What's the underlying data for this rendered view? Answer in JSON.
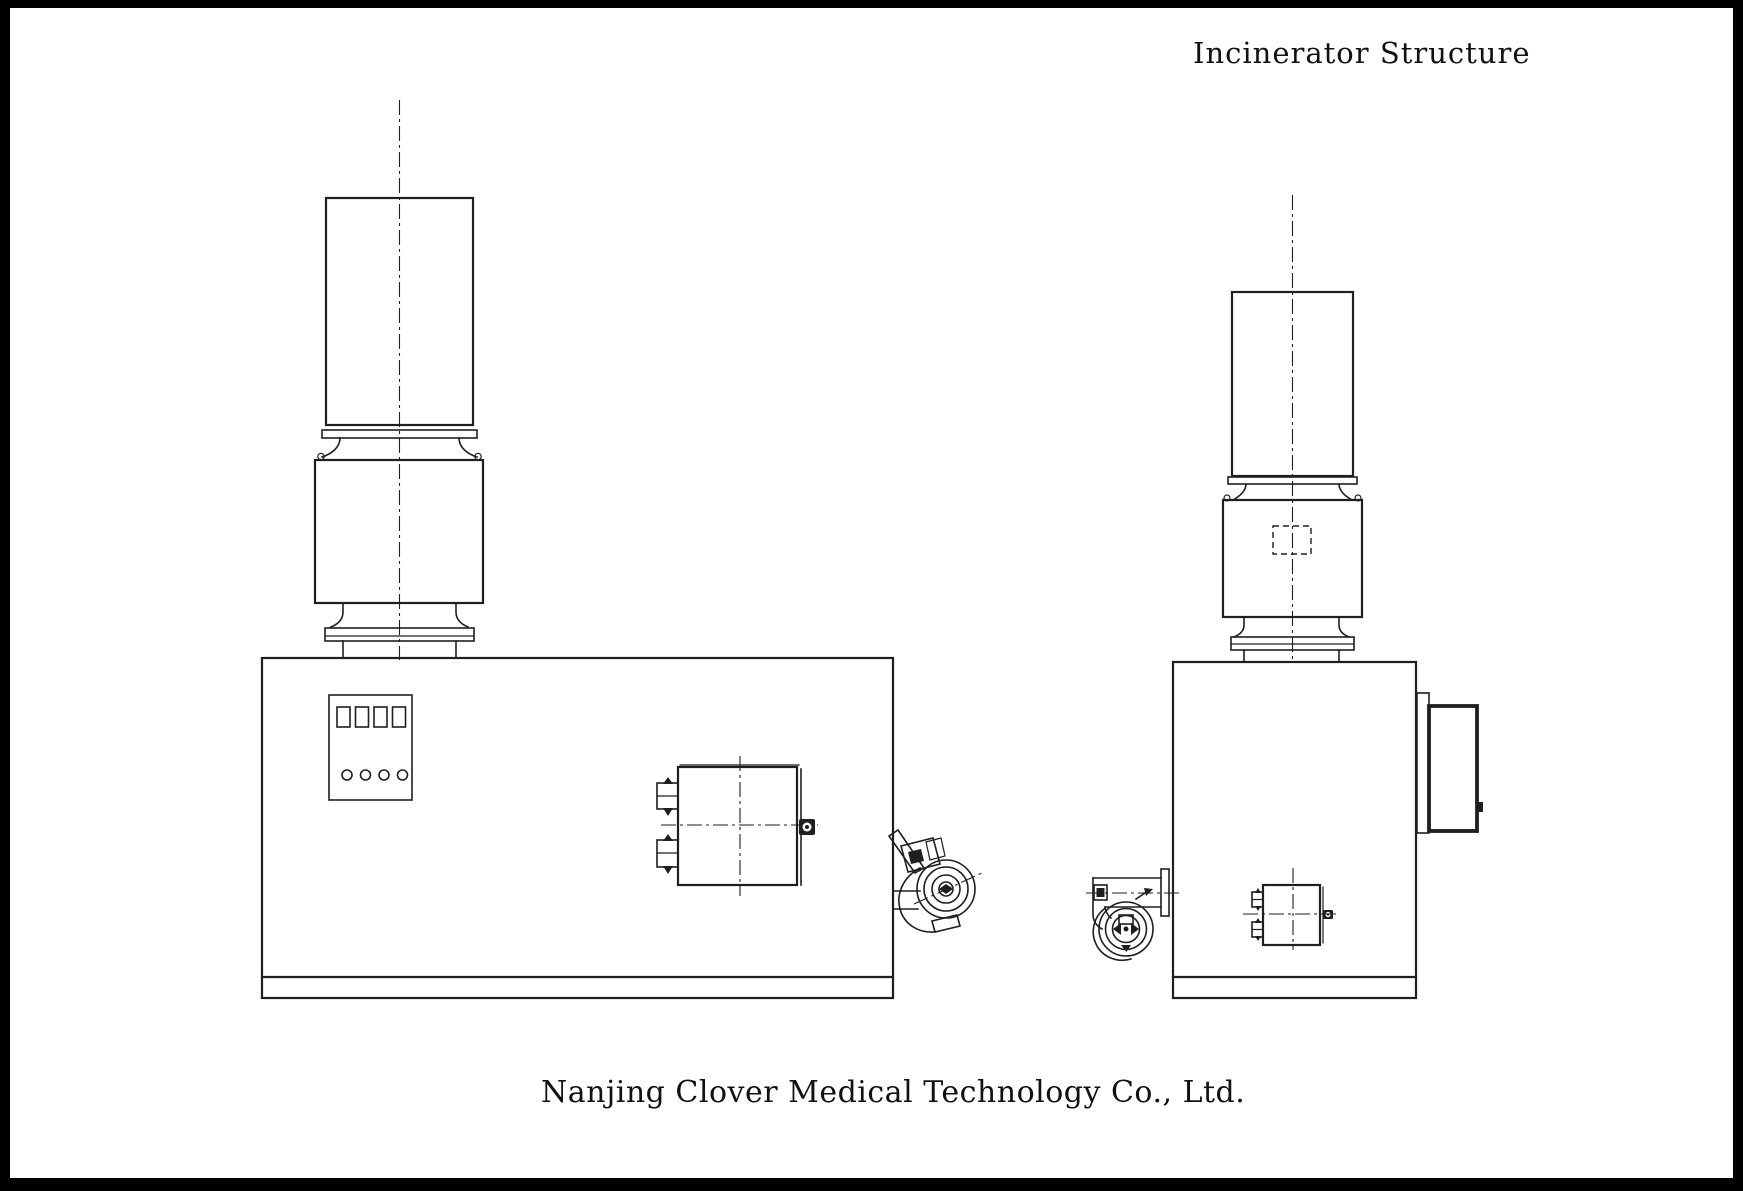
{
  "header": {
    "title": "Incinerator Structure"
  },
  "footer": {
    "company": "Nanjing Clover Medical Technology Co., Ltd."
  },
  "colors": {
    "frame": "#000000",
    "canvas": "#ffffff",
    "line": "#1f1f1f"
  }
}
